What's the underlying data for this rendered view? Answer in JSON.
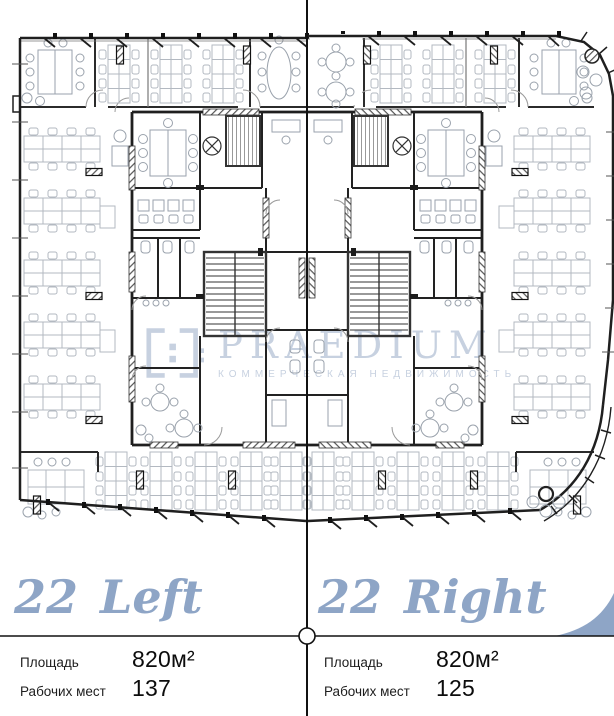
{
  "colors": {
    "accent": "#8EA5C6",
    "watermark": "#C7D1E0",
    "line": "#111111"
  },
  "watermark": {
    "brand": "PRAEDIUM",
    "tagline": "КОММЕРЧЕСКАЯ НЕДВИЖИМОСТЬ"
  },
  "units": [
    {
      "number": "22",
      "name": "Left",
      "stats": [
        {
          "label": "Площадь",
          "value": "820м²"
        },
        {
          "label": "Рабочих мест",
          "value": "137"
        }
      ]
    },
    {
      "number": "22",
      "name": "Right",
      "stats": [
        {
          "label": "Площадь",
          "value": "820м²"
        },
        {
          "label": "Рабочих мест",
          "value": "125"
        }
      ]
    }
  ]
}
